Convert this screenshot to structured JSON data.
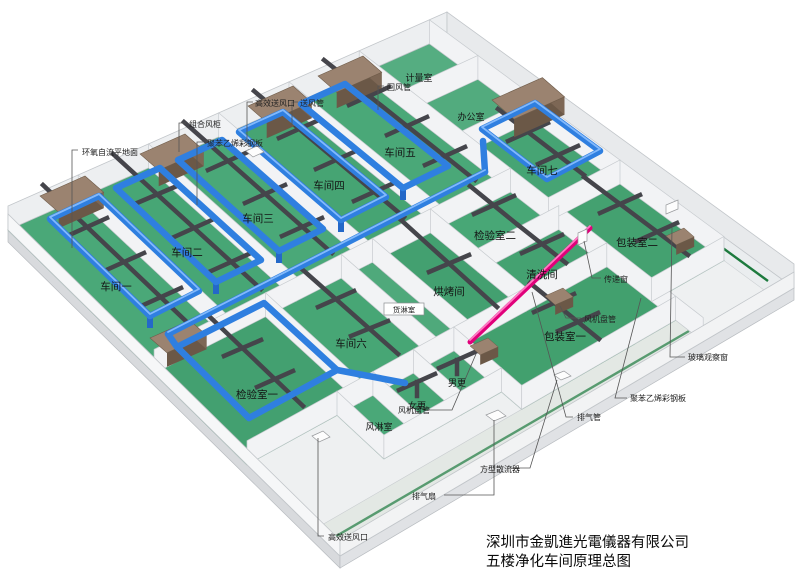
{
  "drawing": {
    "company": "深圳市金凱進光電儀器有限公司",
    "title": "五楼净化车间原理总图"
  },
  "rooms": [
    {
      "id": "workshop-1",
      "label": "车间一"
    },
    {
      "id": "workshop-2",
      "label": "车间二"
    },
    {
      "id": "workshop-3",
      "label": "车间三"
    },
    {
      "id": "workshop-4",
      "label": "车间四"
    },
    {
      "id": "workshop-5",
      "label": "车间五"
    },
    {
      "id": "metrology-room",
      "label": "计量室"
    },
    {
      "id": "office",
      "label": "办公室"
    },
    {
      "id": "workshop-7",
      "label": "车间七"
    },
    {
      "id": "packing-room-2",
      "label": "包装室二"
    },
    {
      "id": "inspection-room-1",
      "label": "检验室一"
    },
    {
      "id": "workshop-6",
      "label": "车间六"
    },
    {
      "id": "cargo-shower-room",
      "label": "货淋室"
    },
    {
      "id": "baking-room",
      "label": "烘烤间"
    },
    {
      "id": "inspection-room-2",
      "label": "检验室二"
    },
    {
      "id": "cleaning-room",
      "label": "清洗间"
    },
    {
      "id": "air-shower-room",
      "label": "风淋室"
    },
    {
      "id": "women-changing-room",
      "label": "女更"
    },
    {
      "id": "men-changing-room",
      "label": "男更"
    },
    {
      "id": "packing-room-1",
      "label": "包装室一"
    }
  ],
  "annotations": [
    {
      "id": "epoxy-self-leveling-floor",
      "label": "环氧自流平地面"
    },
    {
      "id": "combined-air-cabinet",
      "label": "组合风柜"
    },
    {
      "id": "polystyrene-color-steel-panel-top",
      "label": "聚苯乙烯彩钢板"
    },
    {
      "id": "hepa-supply-outlet-top",
      "label": "高效送风口"
    },
    {
      "id": "supply-air-duct",
      "label": "送风管"
    },
    {
      "id": "return-air-duct",
      "label": "回风管"
    },
    {
      "id": "fan-coil-unit-right",
      "label": "风机盘管"
    },
    {
      "id": "glass-observation-window",
      "label": "玻璃观察窗"
    },
    {
      "id": "polystyrene-color-steel-panel-right",
      "label": "聚苯乙烯彩钢板"
    },
    {
      "id": "exhaust-pipe",
      "label": "排气管"
    },
    {
      "id": "pass-through-window",
      "label": "传递窗"
    },
    {
      "id": "fan-coil-unit-bottom",
      "label": "风机盘管"
    },
    {
      "id": "exhaust-fan",
      "label": "排气扇"
    },
    {
      "id": "square-diffuser",
      "label": "方型散流器"
    },
    {
      "id": "hepa-supply-outlet-bottom",
      "label": "高效送风口"
    }
  ],
  "colors": {
    "floor_green": "#4aa878",
    "supply_duct_blue": "#2f7fe0",
    "branch_duct_gray": "#45454b",
    "ahu_brown": "#8a7260",
    "exhaust_pipe_pink": "#e0007a",
    "wall_white": "#f2f3f5",
    "corridor_green_line": "#1d7a3e"
  }
}
